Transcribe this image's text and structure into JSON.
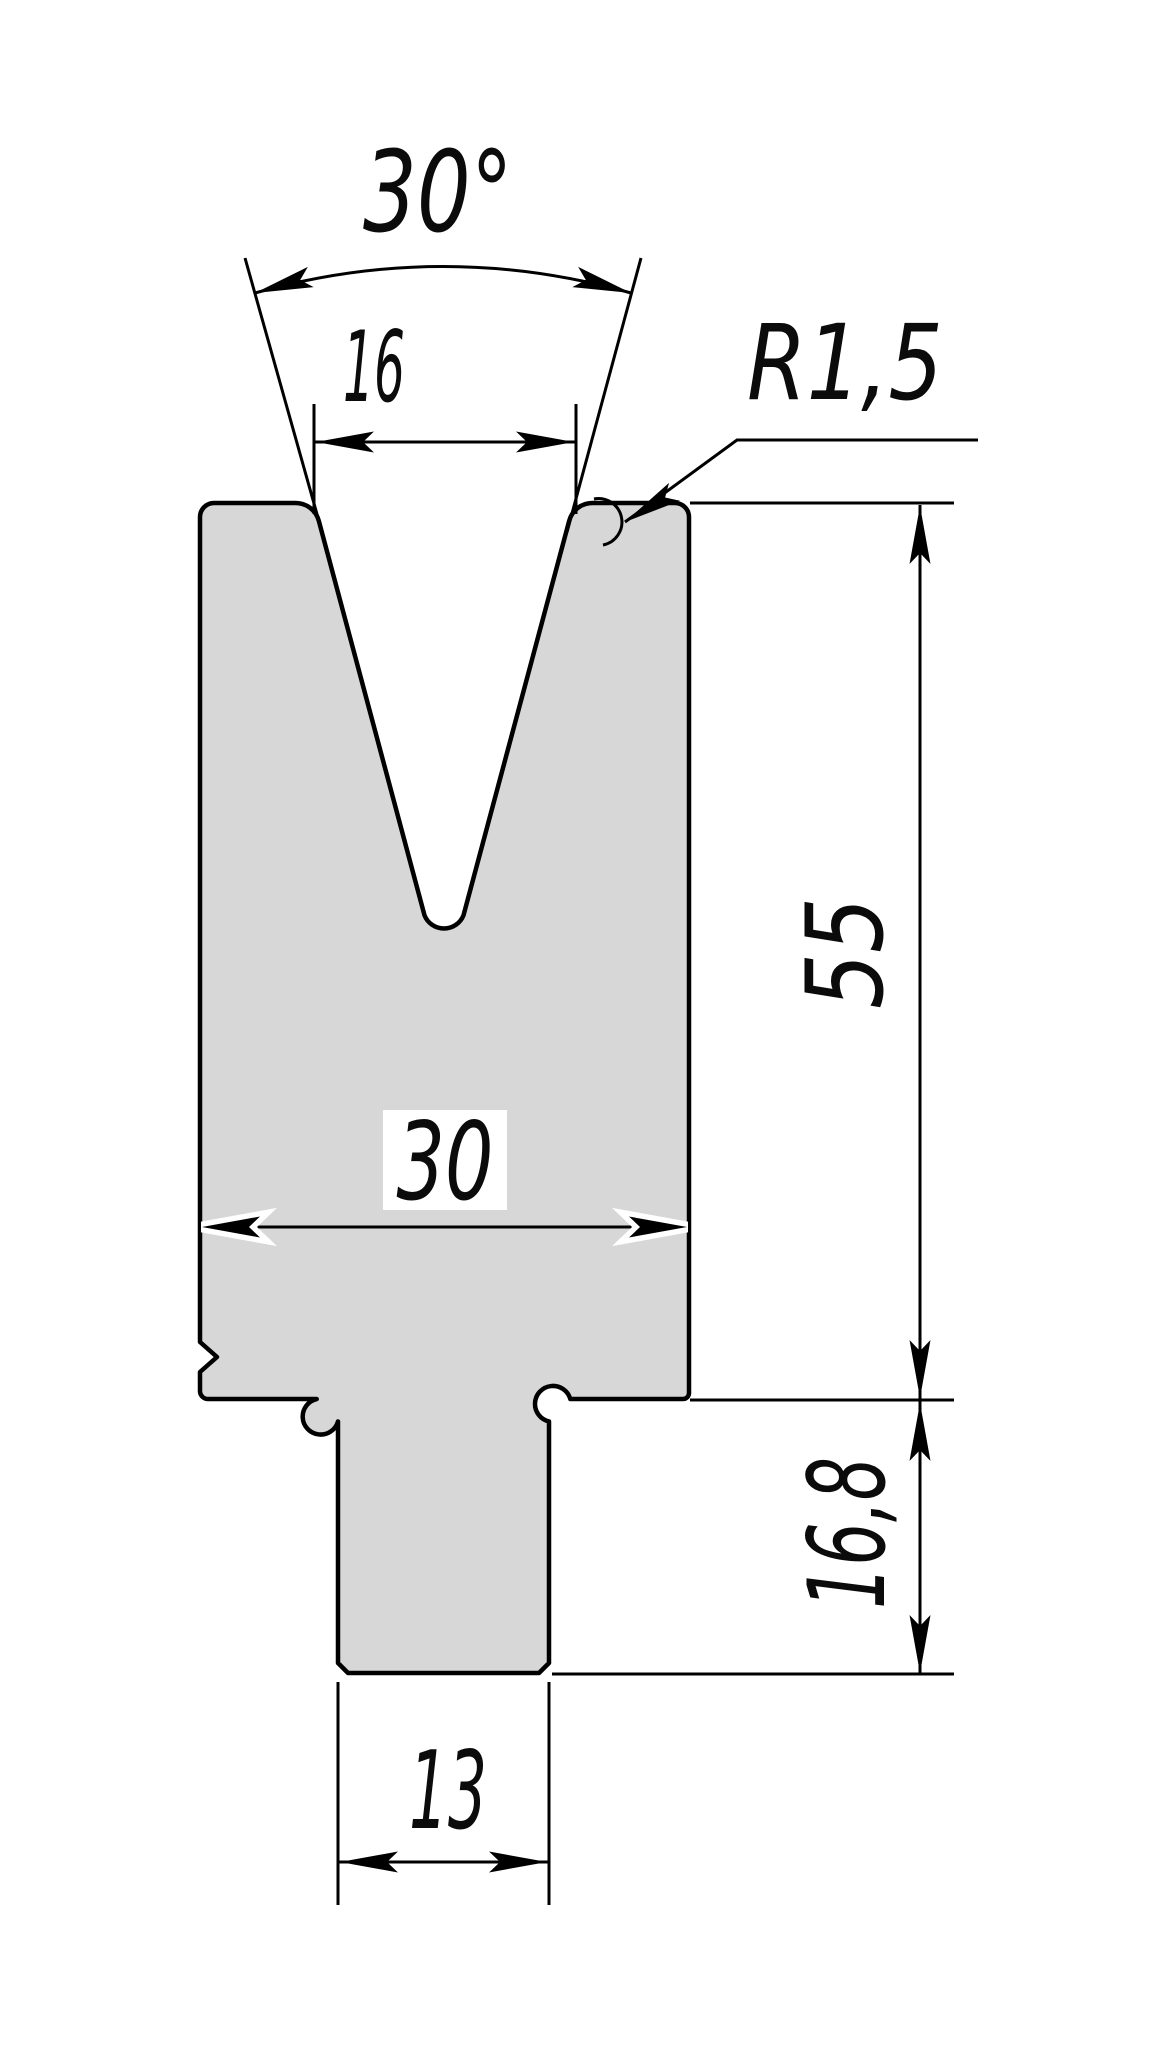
{
  "drawing": {
    "title": "Press-brake V-die cross-section technical drawing",
    "labels": {
      "angle": "30°",
      "opening_width": "16",
      "corner_radius": "R1,5",
      "body_height": "55",
      "body_width": "30",
      "tang_height": "16,8",
      "tang_width": "13"
    },
    "colors": {
      "background": "#ffffff",
      "body": "#d7d7d7",
      "line": "#000000"
    }
  }
}
